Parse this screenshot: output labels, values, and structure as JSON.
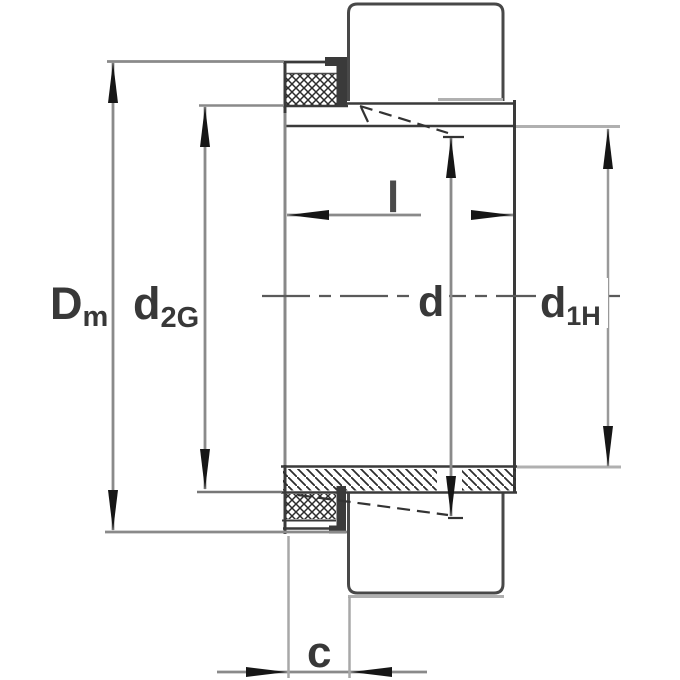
{
  "figure": {
    "kind": "technical-drawing",
    "description": "Sectional dimension drawing of an adapter sleeve with locknut and lock washer",
    "dimension_labels": {
      "Dm": {
        "main": "D",
        "sub": "m"
      },
      "d2G": {
        "main": "d",
        "sub": "2G"
      },
      "d": {
        "main": "d"
      },
      "d1H": {
        "main": "d",
        "sub": "1H"
      },
      "l": {
        "main": "l"
      },
      "c": {
        "main": "c"
      }
    },
    "colors": {
      "background": "#ffffff",
      "object_line": "#3a3a3a",
      "nut_line": "#484848",
      "dimension_line": "#8a8a8a",
      "extension_line": "#b0b0b0",
      "arrow": "#161616",
      "label": "#383838",
      "centerline": "#5a5a5a",
      "hatch": "#2c2c2c"
    }
  }
}
